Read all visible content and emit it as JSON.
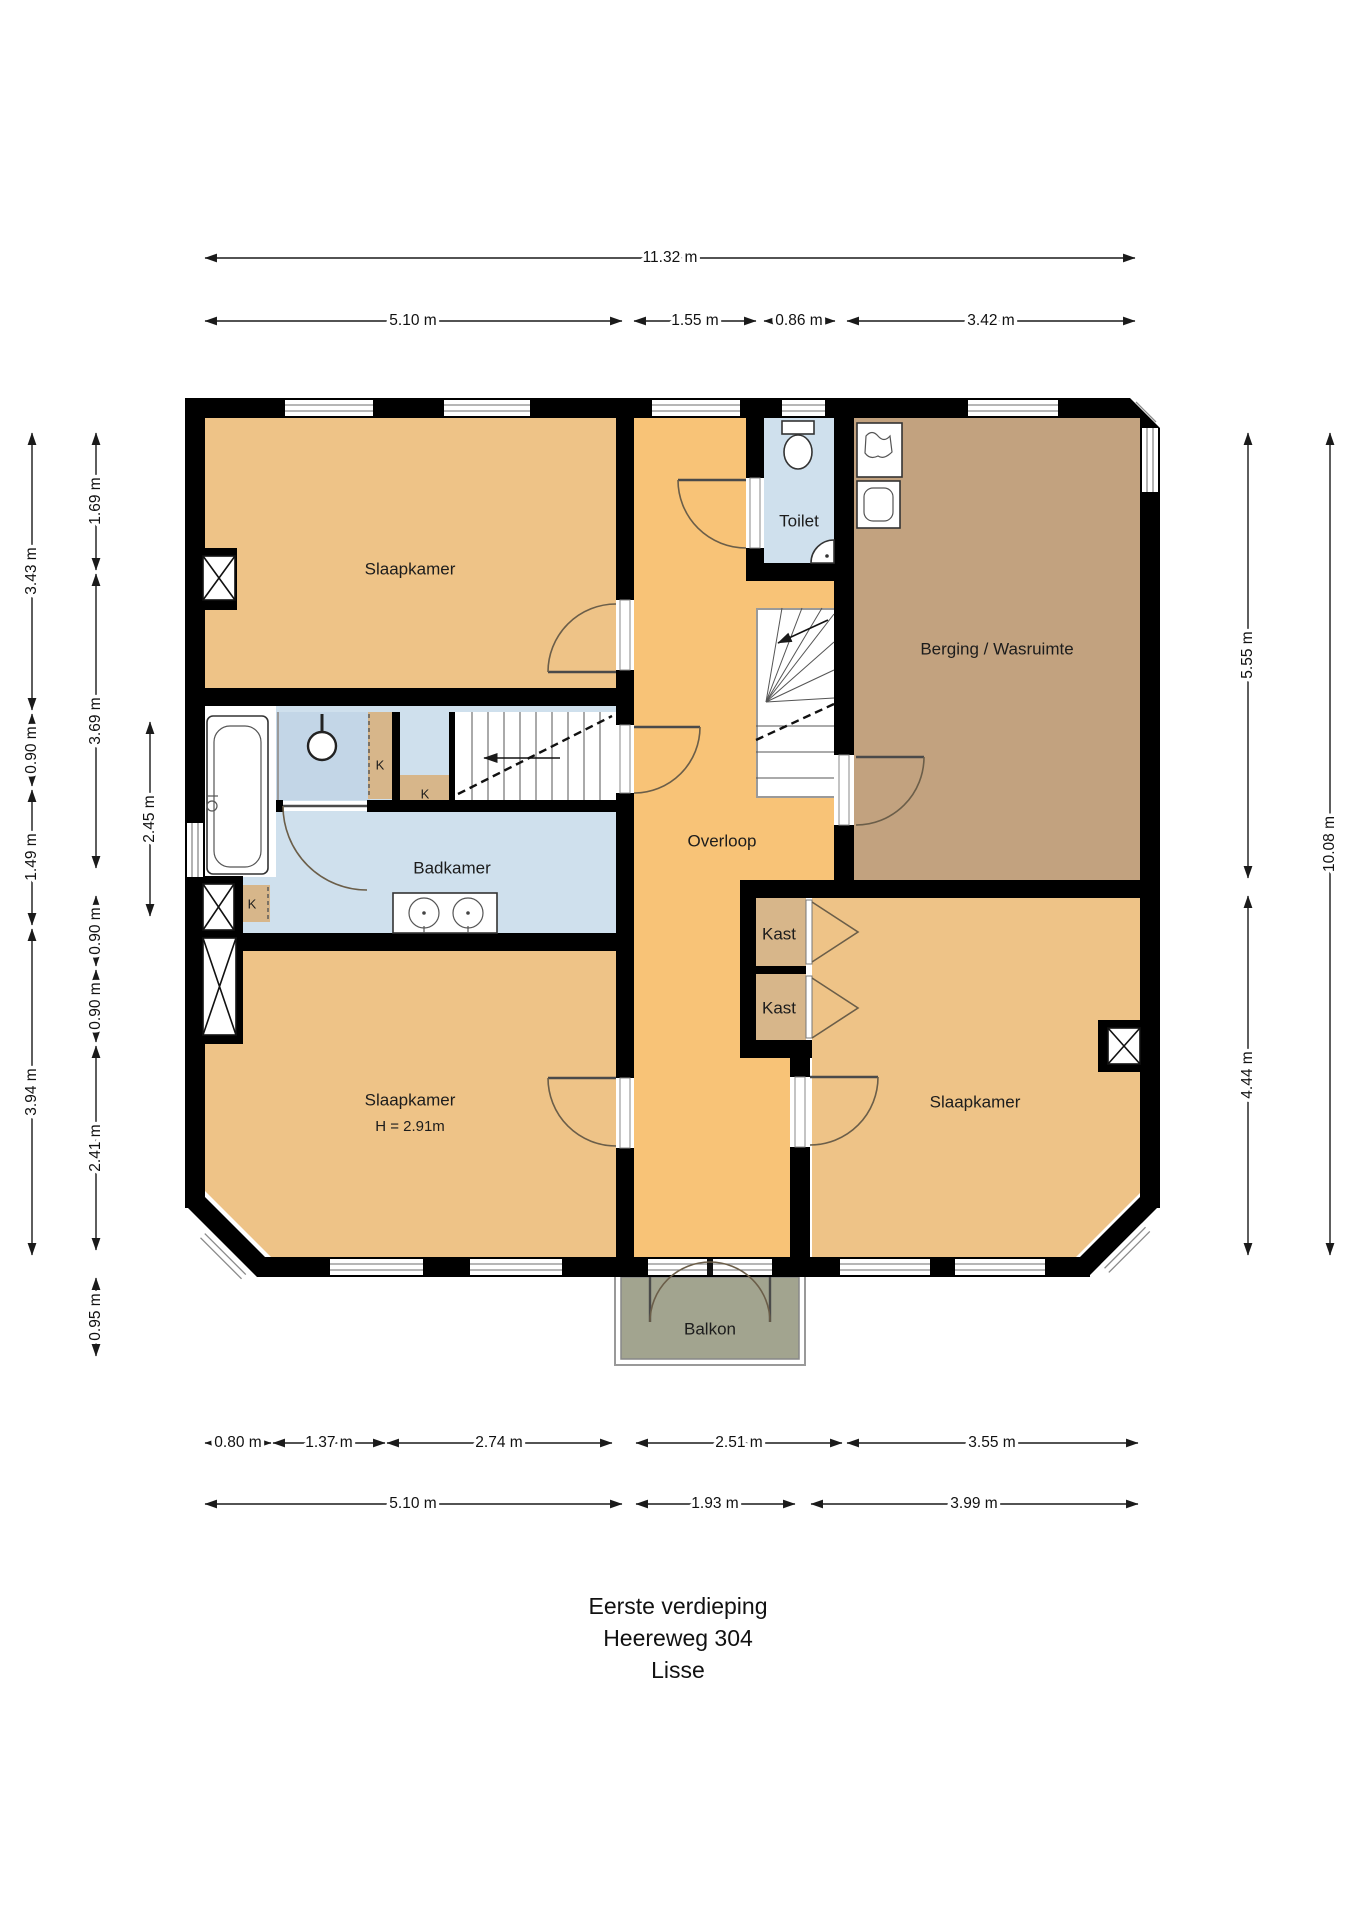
{
  "title_block": {
    "lines": [
      "Eerste verdieping",
      "Heereweg 304",
      "Lisse"
    ]
  },
  "rooms": {
    "bedroom_top_left": "Slaapkamer",
    "toilet": "Toilet",
    "storage": "Berging / Wasruimte",
    "landing": "Overloop",
    "bathroom": "Badkamer",
    "closet_top": "Kast",
    "closet_bottom": "Kast",
    "bedroom_bottom_left": "Slaapkamer",
    "bedroom_bottom_left_height": "H = 2.91m",
    "bedroom_bottom_right": "Slaapkamer",
    "balcony": "Balkon",
    "k_small": "K"
  },
  "dimensions": {
    "overall_width": "11.32 m",
    "top": [
      "5.10 m",
      "1.55 m",
      "0.86 m",
      "3.42 m"
    ],
    "left_outer": [
      "3.43 m",
      "0.90 m",
      "1.49 m",
      "3.94 m"
    ],
    "left_mid": [
      "1.69 m",
      "3.69 m",
      "0.90 m",
      "0.90 m",
      "2.41 m",
      "0.95 m"
    ],
    "left_inner": [
      "2.45 m"
    ],
    "right_inner": [
      "5.55 m",
      "4.44 m"
    ],
    "right_outer": [
      "10.08 m"
    ],
    "bottom_upper": [
      "0.80 m",
      "1.37 m",
      "2.74 m",
      "2.51 m",
      "3.55 m"
    ],
    "bottom_lower": [
      "5.10 m",
      "1.93 m",
      "3.99 m"
    ]
  },
  "colors": {
    "wall": "#000000",
    "bedroom_fill": "#EEC387",
    "landing_fill": "#F8C377",
    "storage_fill": "#C2A27F",
    "bath_fill": "#CFE0ED",
    "shower_fill": "#C3D6E7",
    "closet_fill": "#D7B68A",
    "balcony_fill": "#A2A48F",
    "door_arc": "#6B5E49"
  }
}
